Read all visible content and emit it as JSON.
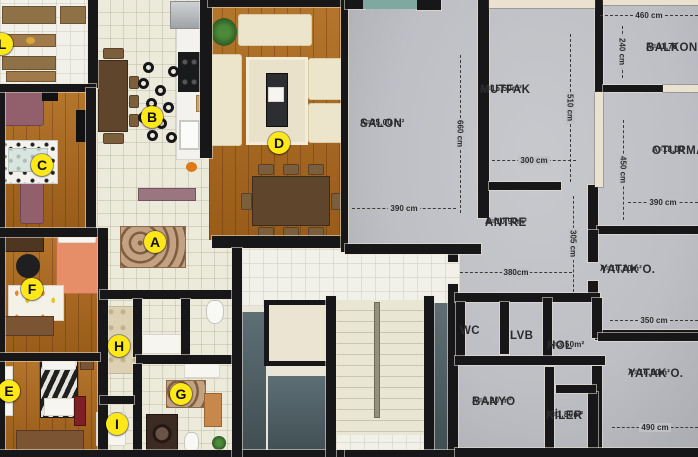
{
  "colors": {
    "marker_bg": "#ffe817",
    "plan_room_fill": "#bfc1c5",
    "wall": "#17171a",
    "wall_trim": "#eae1d0",
    "balcony_glass": "#7fa8a0"
  },
  "markers": [
    {
      "letter": "A",
      "x": 155,
      "y": 242
    },
    {
      "letter": "B",
      "x": 152,
      "y": 117
    },
    {
      "letter": "C",
      "x": 42,
      "y": 165
    },
    {
      "letter": "D",
      "x": 279,
      "y": 143
    },
    {
      "letter": "E",
      "x": 9,
      "y": 391
    },
    {
      "letter": "F",
      "x": 32,
      "y": 289
    },
    {
      "letter": "G",
      "x": 181,
      "y": 394
    },
    {
      "letter": "H",
      "x": 119,
      "y": 346
    },
    {
      "letter": "I",
      "x": 117,
      "y": 424
    },
    {
      "letter": "L",
      "x": 2,
      "y": 44
    }
  ],
  "rooms": {
    "salon": {
      "name": "SALON",
      "area": "A=25,00 m²"
    },
    "mutfak": {
      "name": "MUTFAK",
      "area": "A=15,50m²"
    },
    "balkon": {
      "name": "BALKON",
      "area": "A=11,75"
    },
    "oturma": {
      "name": "OTURMA",
      "area": "A=18,00"
    },
    "antre": {
      "name": "ANTRE",
      "area": "A=10,90m²"
    },
    "yatak_small": {
      "name": "YATAK O.",
      "area": "A=10,70m²"
    },
    "yatak_large": {
      "name": "YATAK O.",
      "area": "A=16,50m²"
    },
    "hol": {
      "name": "HOL",
      "area": "A=3.50m²"
    },
    "banyo": {
      "name": "BANYO",
      "area": "A=6,20 m²"
    },
    "kiler": {
      "name": "KİLER",
      "area": "A=1,80m²"
    },
    "wc": {
      "name": "WC"
    },
    "lvb": {
      "name": "LVB"
    }
  },
  "dimensions": [
    {
      "label": "460 cm",
      "orient": "h",
      "x": 600,
      "y": 15,
      "len": 98
    },
    {
      "label": "240 cm",
      "orient": "v",
      "x": 622,
      "y": 26,
      "len": 52
    },
    {
      "label": "510 cm",
      "orient": "v",
      "x": 570,
      "y": 34,
      "len": 148
    },
    {
      "label": "660 cm",
      "orient": "v",
      "x": 460,
      "y": 55,
      "len": 158
    },
    {
      "label": "300 cm",
      "orient": "h",
      "x": 492,
      "y": 160,
      "len": 84
    },
    {
      "label": "390 cm",
      "orient": "h",
      "x": 352,
      "y": 208,
      "len": 104
    },
    {
      "label": "450 cm",
      "orient": "v",
      "x": 623,
      "y": 120,
      "len": 100
    },
    {
      "label": "390 cm",
      "orient": "h",
      "x": 628,
      "y": 202,
      "len": 70
    },
    {
      "label": "305 cm",
      "orient": "v",
      "x": 573,
      "y": 196,
      "len": 96
    },
    {
      "label": "380cm",
      "orient": "h",
      "x": 460,
      "y": 272,
      "len": 112
    },
    {
      "label": "350 cm",
      "orient": "h",
      "x": 610,
      "y": 320,
      "len": 88
    },
    {
      "label": "490 cm",
      "orient": "h",
      "x": 612,
      "y": 427,
      "len": 86
    }
  ]
}
